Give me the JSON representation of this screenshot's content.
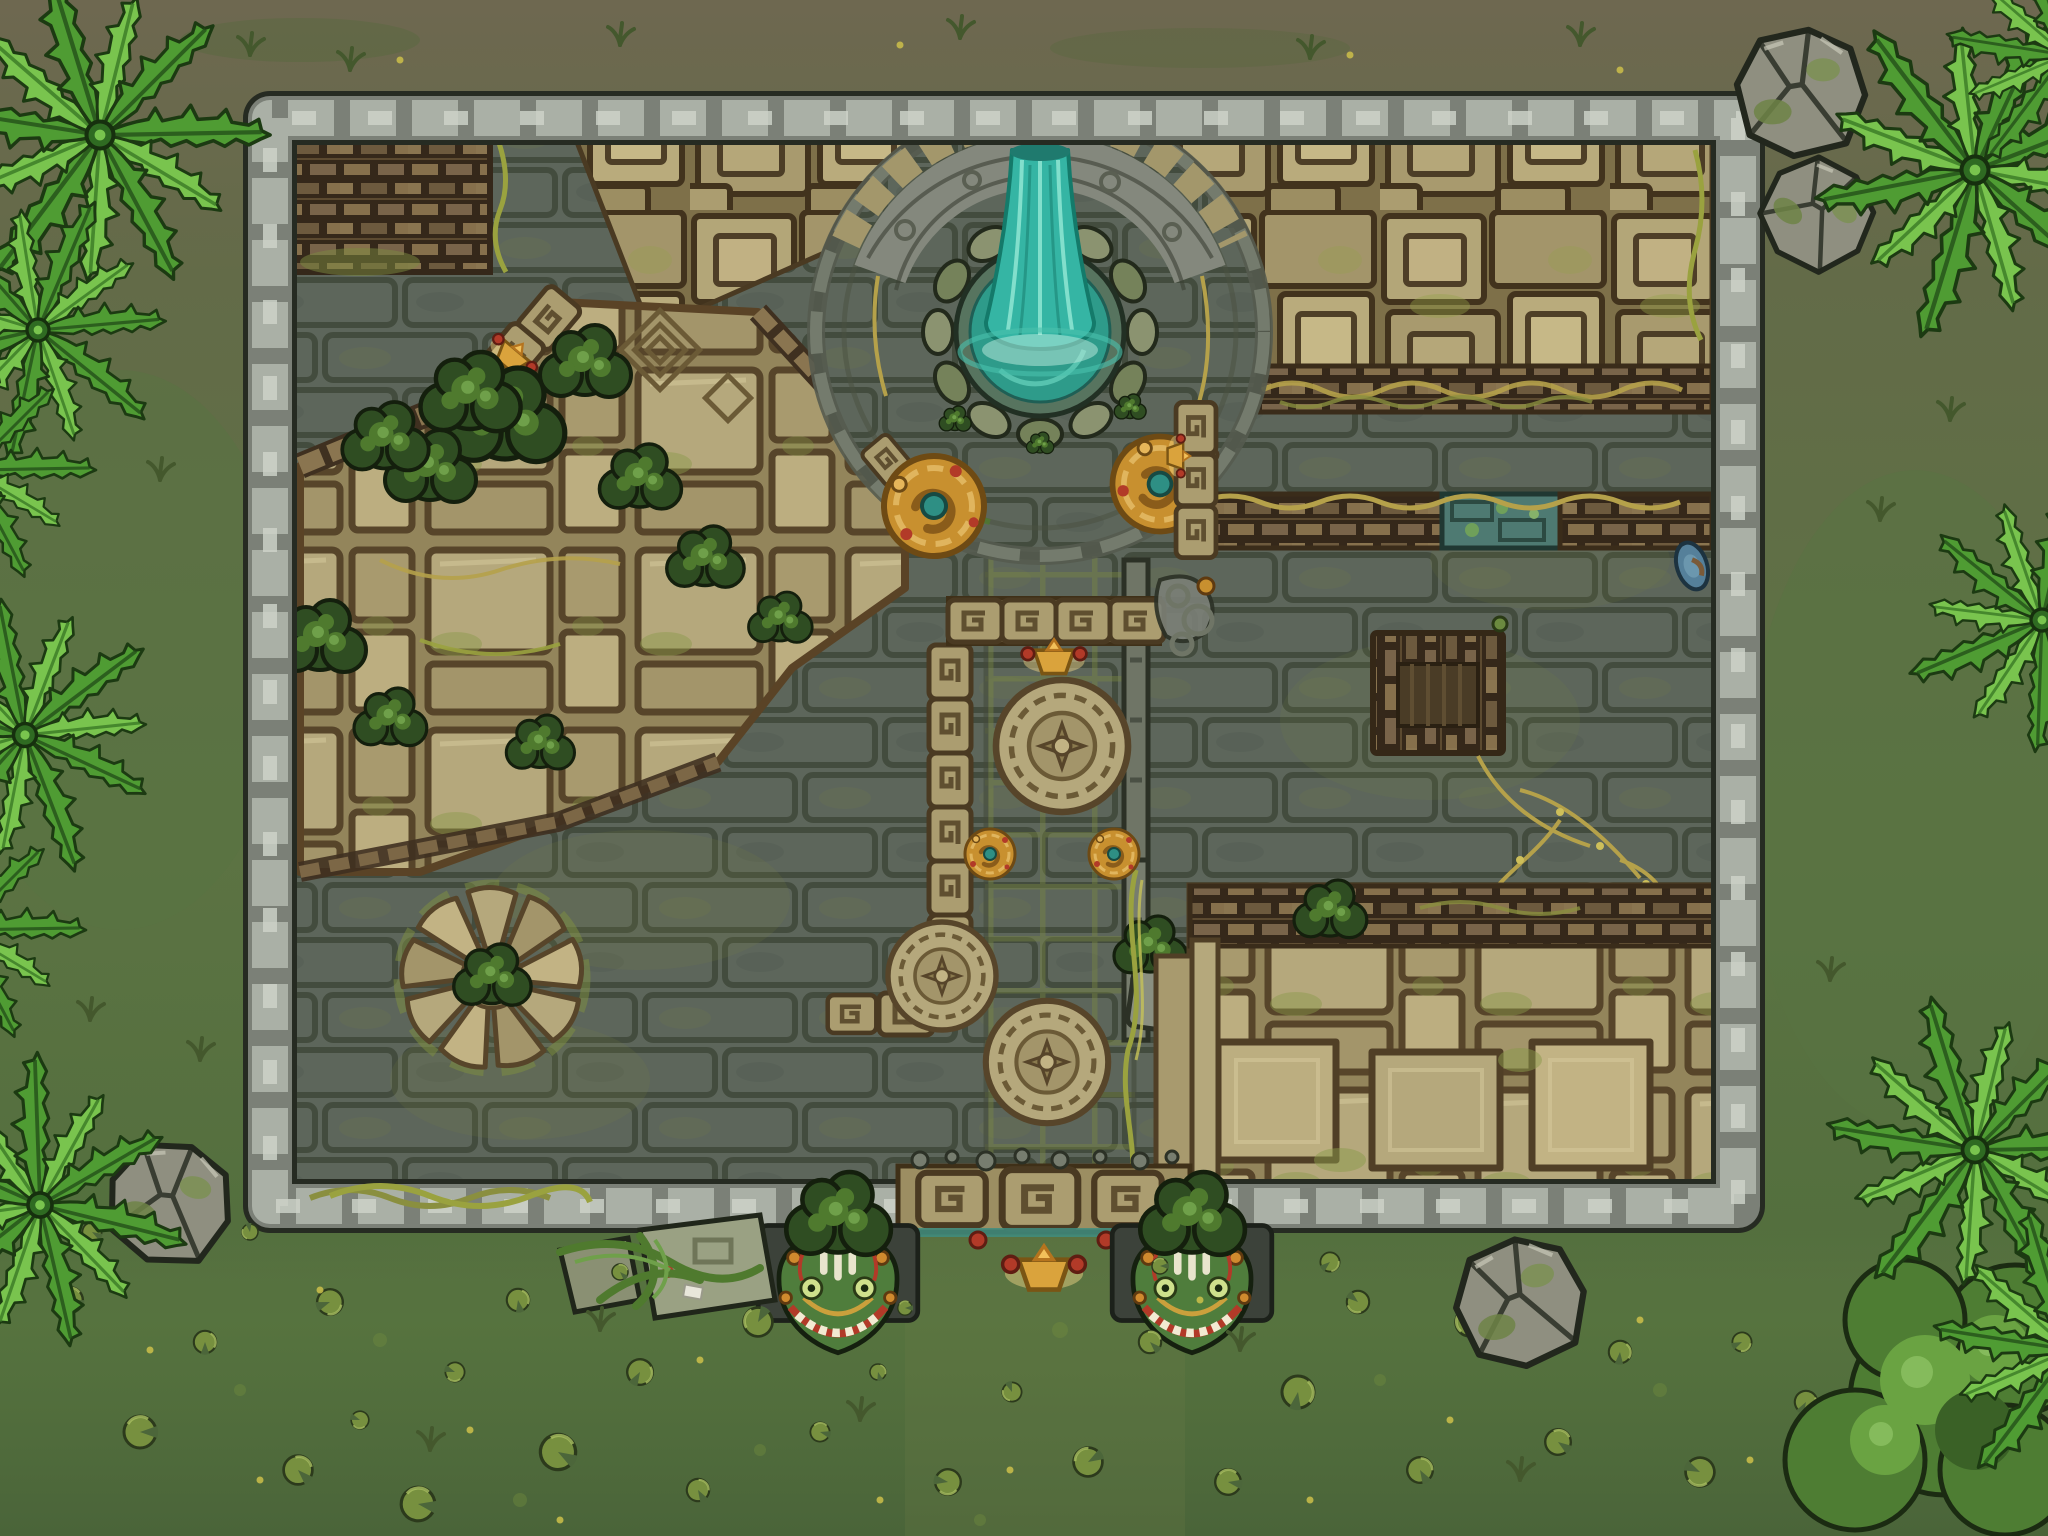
{
  "canvas": {
    "width": 2048,
    "height": 1536
  },
  "map": {
    "kind": "top-down jungle temple ruins battle map",
    "features": [
      {
        "id": "temple-courtyard",
        "label": "walled temple courtyard"
      },
      {
        "id": "boulder-wall",
        "label": "grey boulder perimeter wall"
      },
      {
        "id": "waterfall-fountain",
        "label": "turquoise waterfall fountain"
      },
      {
        "id": "fountain-plaza",
        "label": "circular fountain plaza"
      },
      {
        "id": "stone-arch",
        "label": "carved stone arch"
      },
      {
        "id": "rubble-field",
        "label": "collapsed tan masonry rubble"
      },
      {
        "id": "brick-ruin",
        "label": "brown brick ruin remnant"
      },
      {
        "id": "overgrown-terrace",
        "label": "overgrown stone terrace"
      },
      {
        "id": "stone-rosette",
        "label": "circular stone rosette"
      },
      {
        "id": "central-walkway",
        "label": "medallion walkway"
      },
      {
        "id": "walkway-medallions",
        "label": "carved sun medallions"
      },
      {
        "id": "coil-statues",
        "label": "gilded serpent-coil statues"
      },
      {
        "id": "square-well",
        "label": "brick well platform"
      },
      {
        "id": "mossy-wall-gap",
        "label": "mossy collapsed wall section"
      },
      {
        "id": "south-terrace",
        "label": "stepped stone terrace"
      },
      {
        "id": "serpent-gate",
        "label": "south serpent gate"
      },
      {
        "id": "serpent-statues",
        "label": "green serpent head statues"
      },
      {
        "id": "fallen-ruins",
        "label": "vine-wrapped fallen blocks"
      },
      {
        "id": "swamp",
        "label": "lily pad swamp"
      },
      {
        "id": "palm-trees",
        "label": "jungle palm trees"
      },
      {
        "id": "boulders",
        "label": "mossy boulders"
      },
      {
        "id": "tree-canopy",
        "label": "leafy jungle canopy"
      }
    ]
  },
  "palette": {
    "ground_top": "#6e6850",
    "ground_mid": "#5d7243",
    "swamp": "#57743f",
    "swamp_deep": "#4a6439",
    "cobble": "#5d665b",
    "cobble_line": "#3a4233",
    "tan": "#ab9d70",
    "tan_light": "#b5a87c",
    "tan_dark": "#6b5a36",
    "brick": "#7c6746",
    "wall_light": "#aab0a6",
    "wall_mid": "#7b8077",
    "arch_grey": "#84887d",
    "water": "#35b5a4",
    "water_light": "#8fe6d4",
    "water_deep": "#1f7a6e",
    "pool": "#2e9b8a",
    "moss": "#7c8a3f",
    "bush_dark": "#2f4d22",
    "bush_light": "#4f7a2e",
    "palm_mid": "#4f9c33",
    "palm_light": "#79c44e",
    "vine_dry": "#b5a14a",
    "gold": "#daa33c",
    "red": "#b23a28",
    "serpent": "#4f7d3c",
    "teal_stone": "#4e7a72",
    "boulder": "#8f8f80",
    "lily": "#77903f"
  }
}
